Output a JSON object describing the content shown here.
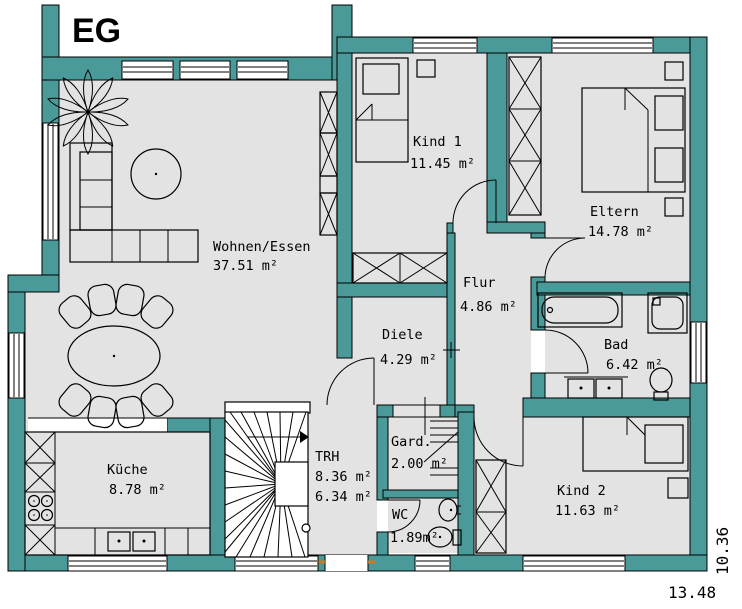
{
  "title": "EG",
  "colors": {
    "wall": "#4b9a9a",
    "floor": "#e3e3e3",
    "line": "#000000",
    "entry_tick": "#c87a28"
  },
  "rooms": {
    "wohnen": {
      "name": "Wohnen/Essen",
      "area": "37.51 m²"
    },
    "kind1": {
      "name": "Kind  1",
      "area": "11.45 m²"
    },
    "eltern": {
      "name": "Eltern",
      "area": "14.78 m²"
    },
    "flur": {
      "name": "Flur",
      "area": "4.86 m²"
    },
    "diele": {
      "name": "Diele",
      "area": "4.29 m²"
    },
    "bad": {
      "name": "Bad",
      "area": "6.42 m²"
    },
    "kueche": {
      "name": "Küche",
      "area": "8.78 m²"
    },
    "trh": {
      "name": "TRH",
      "area": "8.36 m²",
      "area2": "6.34 m²"
    },
    "gard": {
      "name": "Gard.",
      "area": "2.00 m²"
    },
    "wc": {
      "name": "WC",
      "area": "1.89m²"
    },
    "kind2": {
      "name": "Kind 2",
      "area": "11.63 m²"
    }
  },
  "dimensions": {
    "width_label": "13.48",
    "height_label": "10.36"
  }
}
